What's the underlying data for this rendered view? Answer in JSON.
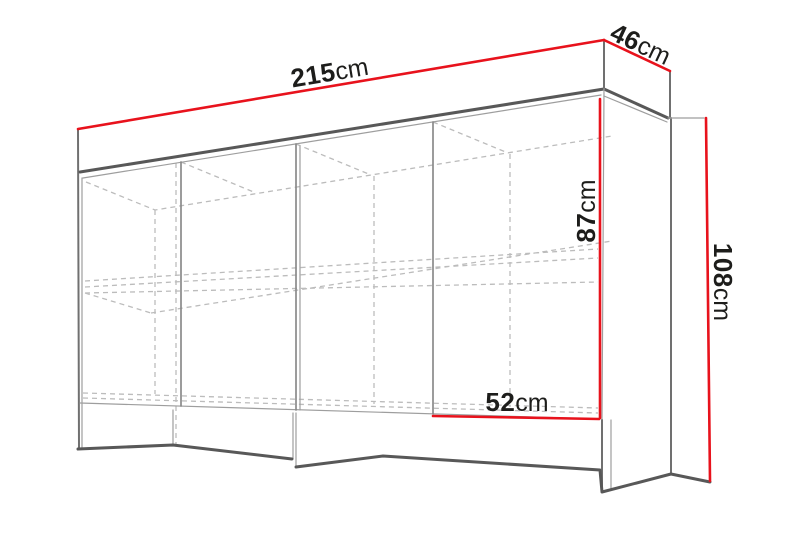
{
  "diagram": {
    "kind": "furniture-dimension-drawing",
    "description": "Perspective wireframe line drawing of a sideboard cabinet with red measurement lines",
    "colors": {
      "dimension": "#e8121c",
      "label": "#1d1d1b",
      "outline": "#585858",
      "hidden": "#bcbcbc",
      "background": "#ffffff"
    },
    "dimensions": [
      {
        "id": "width",
        "value": "215",
        "unit": "cm"
      },
      {
        "id": "depth",
        "value": "46",
        "unit": "cm"
      },
      {
        "id": "opening_height",
        "value": "87",
        "unit": "cm"
      },
      {
        "id": "total_height",
        "value": "108",
        "unit": "cm"
      },
      {
        "id": "section_width",
        "value": "52",
        "unit": "cm"
      }
    ]
  }
}
